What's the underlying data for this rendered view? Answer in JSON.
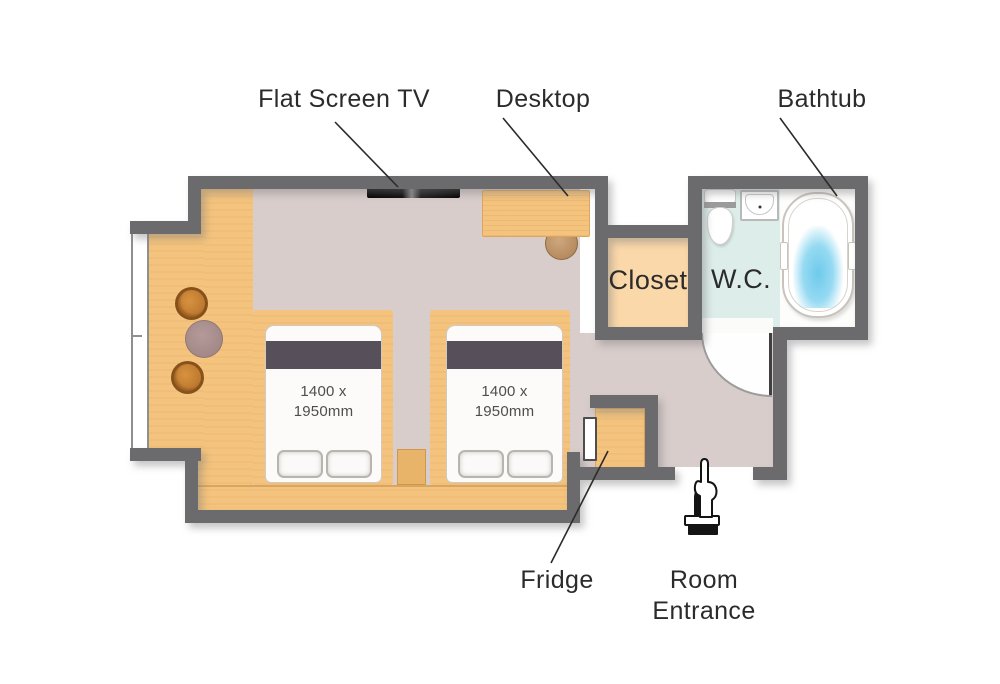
{
  "floorplan": {
    "labels": {
      "flat_screen_tv": "Flat Screen TV",
      "desktop": "Desktop",
      "bathtub": "Bathtub",
      "closet": "Closet",
      "wc": "W.C.",
      "fridge": "Fridge",
      "room_entrance_line1": "Room",
      "room_entrance_line2": "Entrance"
    },
    "beds": [
      {
        "size_line1": "1400 x",
        "size_line2": "1950mm"
      },
      {
        "size_line1": "1400 x",
        "size_line2": "1950mm"
      }
    ],
    "colors": {
      "wall": "#6b6b6d",
      "wood": "#f4c37d",
      "floor-main": "#d9cdcb",
      "closet-floor": "#fbd8a9",
      "wc-floor": "#ddede9",
      "bath-floor": "#fdfdfb",
      "bed-stripe": "#57505a",
      "water": "#6ecaec",
      "label-text": "#2b2b2b"
    },
    "icons": {
      "entrance_marker": "pointing-hand-icon"
    }
  }
}
